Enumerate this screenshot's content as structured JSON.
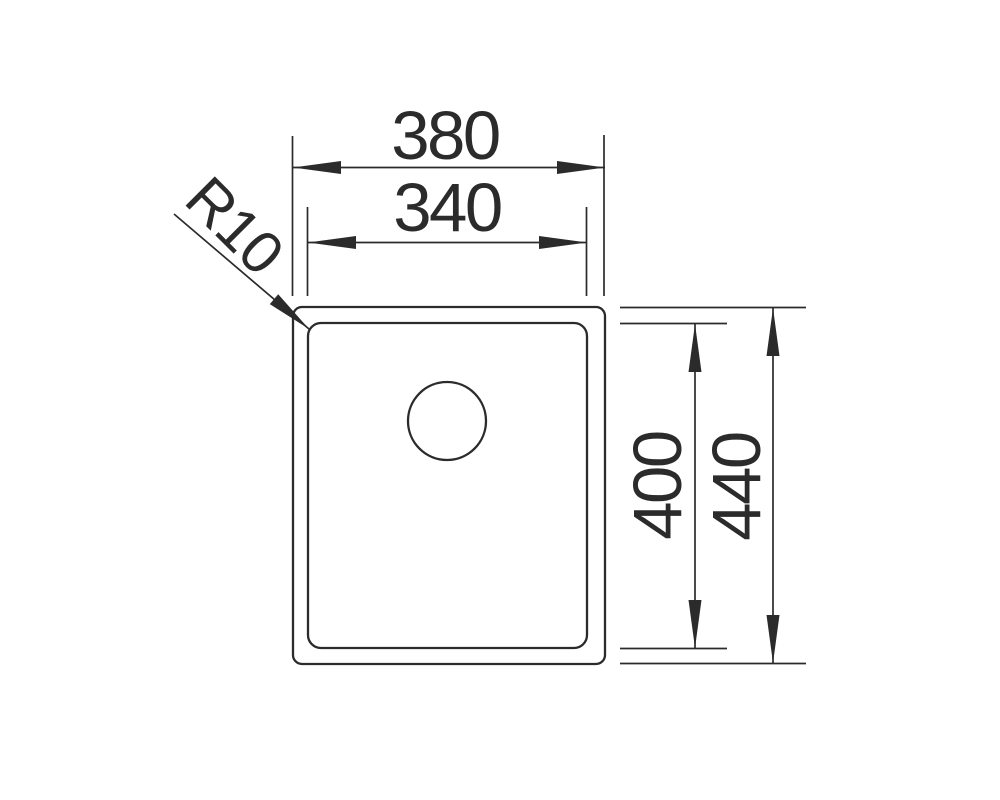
{
  "colors": {
    "line": "#2b2b2b",
    "background": "#ffffff"
  },
  "dimensions": {
    "outer_width": {
      "label": "380",
      "value": 380
    },
    "inner_width": {
      "label": "340",
      "value": 340
    },
    "inner_height": {
      "label": "400",
      "value": 400
    },
    "outer_height": {
      "label": "440",
      "value": 440
    },
    "corner_radius": {
      "label": "R10",
      "value": 10
    }
  }
}
